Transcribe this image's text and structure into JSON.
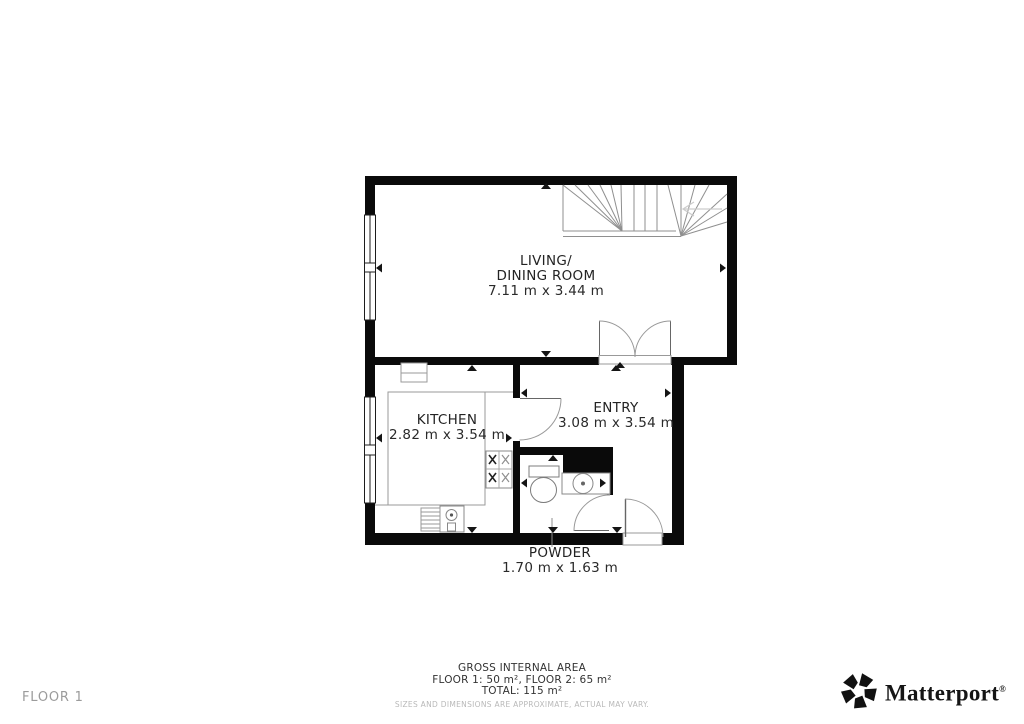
{
  "plan": {
    "rooms": {
      "living": {
        "line1": "LIVING/",
        "line2": "DINING ROOM",
        "dims": "7.11 m x 3.44 m"
      },
      "kitchen": {
        "name": "KITCHEN",
        "dims": "2.82 m x 3.54 m"
      },
      "entry": {
        "name": "ENTRY",
        "dims": "3.08 m x 3.54 m"
      },
      "powder": {
        "name": "POWDER",
        "dims": "1.70 m x 1.63 m"
      }
    }
  },
  "footer": {
    "title": "GROSS INTERNAL AREA",
    "floors": "FLOOR 1: 50 m², FLOOR 2: 65 m²",
    "total": "TOTAL: 115 m²",
    "disclaimer": "SIZES AND DIMENSIONS ARE APPROXIMATE, ACTUAL MAY VARY."
  },
  "floor_label": "FLOOR 1",
  "brand": {
    "name": "Matterport",
    "registered": "®"
  },
  "colors": {
    "wall": "#0a0a0a",
    "fixture_line": "#8f8f8f",
    "door_line": "#999999",
    "label_text": "#232323",
    "muted_text": "#9b9b9b",
    "disclaimer_text": "#b9b9b9"
  }
}
